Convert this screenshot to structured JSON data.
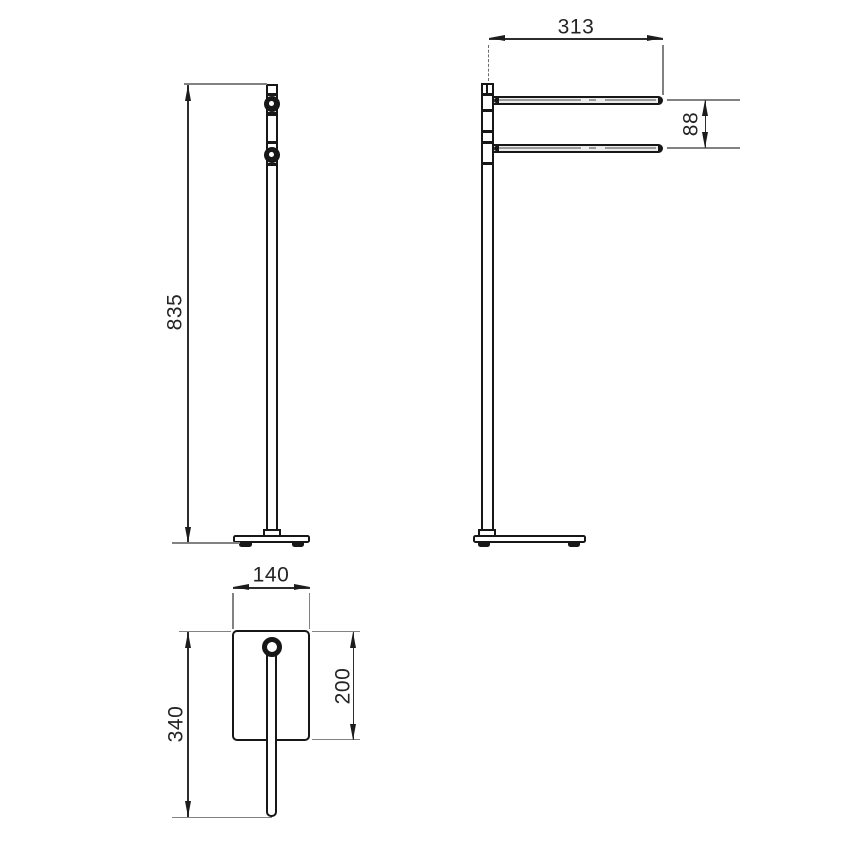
{
  "front_view": {
    "height_label": "835"
  },
  "side_view": {
    "arm_length_label": "313",
    "arm_spacing_label": "88"
  },
  "top_view": {
    "base_width_label": "140",
    "overall_depth_label": "340",
    "base_depth_label": "200"
  },
  "colors": {
    "object_line": "#171717",
    "dimension_line": "#2d2d2d",
    "extension_line": "#828282",
    "background": "#ffffff"
  }
}
